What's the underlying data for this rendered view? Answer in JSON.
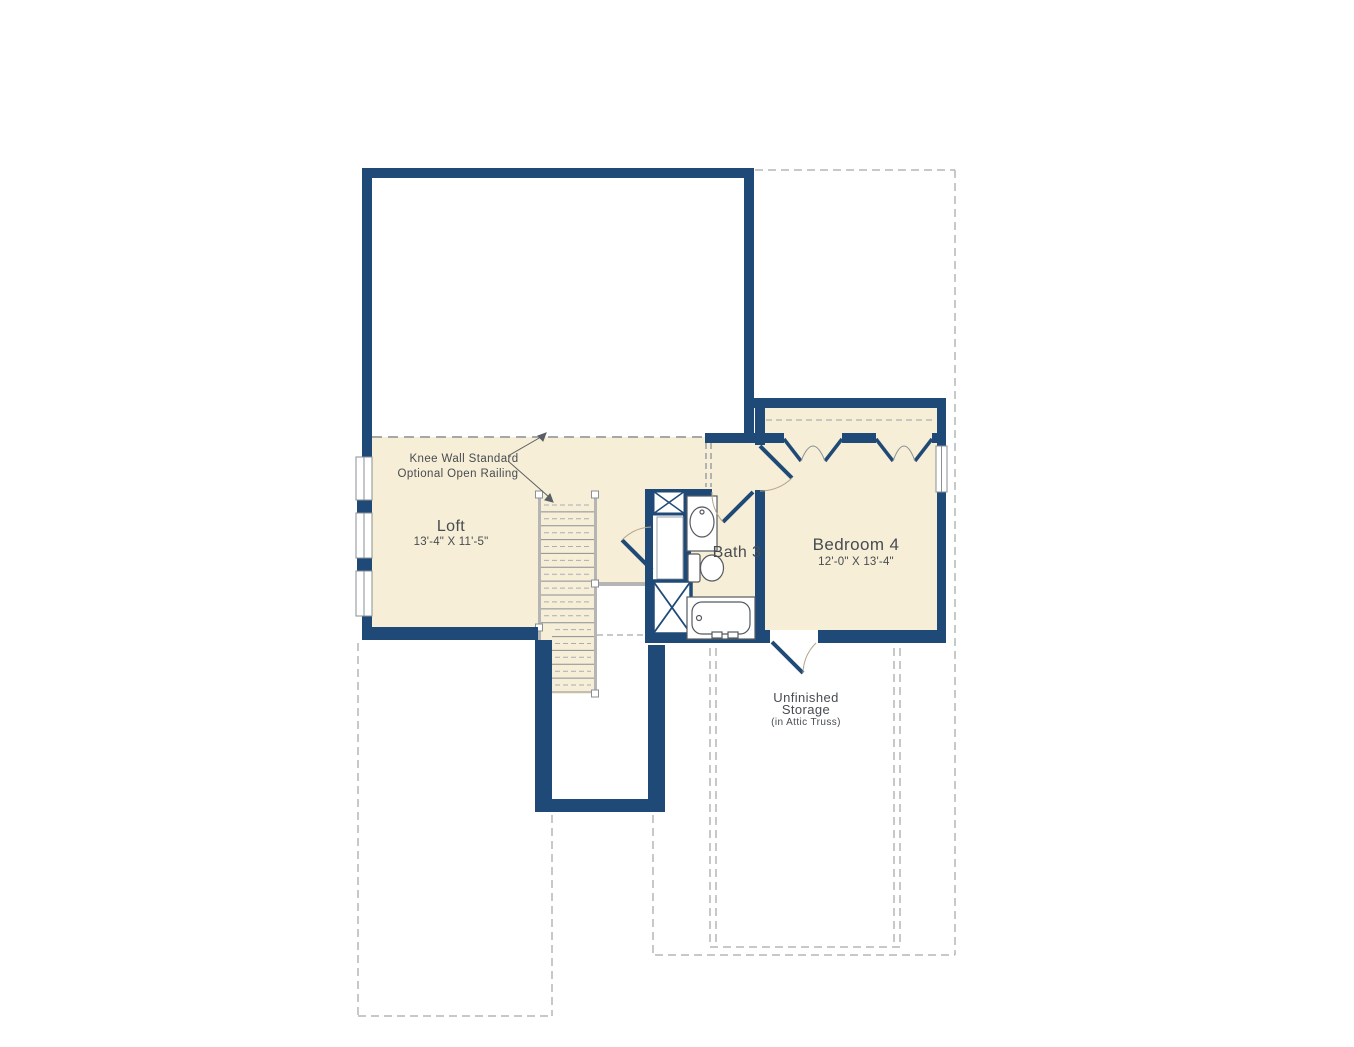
{
  "plan": {
    "type": "floor-plan",
    "rooms": {
      "loft": {
        "name": "Loft",
        "dims": "13'-4\" X 11'-5\""
      },
      "bath": {
        "name": "Bath 3"
      },
      "bedroom": {
        "name": "Bedroom 4",
        "dims": "12'-0\" X 13'-4\""
      },
      "storage": {
        "line1": "Unfinished",
        "line2": "Storage",
        "line3": "(in Attic Truss)"
      }
    },
    "annotations": {
      "knee_wall_line1": "Knee Wall Standard",
      "knee_wall_line2": "Optional Open Railing"
    },
    "colors": {
      "wall": "#1f4a77",
      "floor": "#f6eed6",
      "dashed_outline": "#b4b9b4",
      "stair_rail": "#b5b5b5",
      "fixture_outline": "#555a60",
      "door_arc": "#b5a58c",
      "label_text": "#474c52"
    }
  }
}
